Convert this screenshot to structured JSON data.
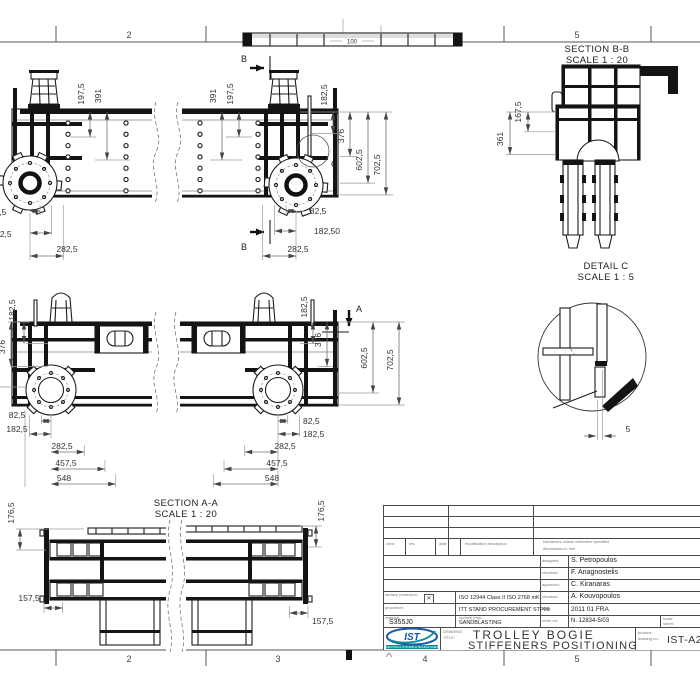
{
  "frame": {
    "zones_top": [
      "2",
      "5"
    ],
    "zones_bottom": [
      "2",
      "3",
      "4",
      "5"
    ]
  },
  "views": {
    "strip": {
      "dim": "100"
    },
    "cut_labels": {
      "a": "A",
      "b": "B"
    },
    "section_bb": {
      "title": "SECTION B-B",
      "scale": "SCALE 1 : 20"
    },
    "section_aa": {
      "title": "SECTION A-A",
      "scale": "SCALE 1 : 20"
    },
    "detail_c": {
      "title": "DETAIL C",
      "scale": "SCALE 1 : 5",
      "ref": "C"
    }
  },
  "dims": {
    "top": {
      "tl1": "197,5",
      "tl2": "391",
      "tr1": "391",
      "tr2": "197,5",
      "rv1": "182,5",
      "rv2": "376",
      "rv3": "602,5",
      "rv4": "702,5",
      "br1": "82,5",
      "br2": "182,50",
      "br3": "282,5",
      "bl1": "82,5",
      "bl2": "182,5",
      "bl3": "282,5"
    },
    "mid": {
      "lv1": "182,5",
      "lv2": "376",
      "rv1": "182,5",
      "rv2": "376",
      "rv3": "602,5",
      "rv4": "702,5",
      "bl1": "82,5",
      "bl2": "182,5",
      "bl3": "282,5",
      "bl4": "457,5",
      "bl5": "548",
      "br1": "82,5",
      "br2": "182,5",
      "br3": "282,5",
      "br4": "457,5",
      "br5": "548"
    },
    "aa": {
      "vl": "176,5",
      "vr": "176,5",
      "hl": "157,5",
      "hr": "157,5"
    },
    "bb": {
      "v1": "167,5",
      "v2": "361"
    },
    "dc": {
      "t": "5"
    }
  },
  "title_block": {
    "header": {
      "c1": "zone",
      "c2": "rev.",
      "c3": "date",
      "c4": "modification description",
      "c5a": "tolerances unless otherwise specified",
      "c5b": "dimensions in mm"
    },
    "approvals": [
      {
        "label": "designed:",
        "value": "S. Petropoulos"
      },
      {
        "label": "checked:",
        "value": "F. Anagnostelis"
      },
      {
        "label": "approved:",
        "value": "C. Kiranaras"
      },
      {
        "label": "released:",
        "value": "A. Kouvopoulos"
      },
      {
        "label": "date:",
        "value": "2011 01 FRA"
      },
      {
        "label": "order no:",
        "value": "N. 12834-5/03"
      }
    ],
    "specs": {
      "surface_label": "surface protection:",
      "spec1": "ISO 12944 Class II   ISO 2768 mK",
      "proc_label": "procedure:",
      "spec2": "ITT STAND PROCUREMENT STP09",
      "material_label": "material:",
      "material": "S355J0",
      "prep_label": "surface prep.:",
      "spec3": "SANDBLASTING"
    },
    "scale_label": "scale:",
    "sheet_label": "sheet:",
    "title_label1": "DRAWING",
    "title_label2": "TITLE:",
    "num_label1": "product:",
    "num_label2": "drawing no:",
    "title1": "TROLLEY BOGIE",
    "title2": "STIFFENERS POSITIONING",
    "drawing_no": "IST-A23",
    "logo": {
      "text": "IST",
      "tagline": "INDUSTRIAL SYSTEMS & TECHNOLOGIES"
    },
    "colors": {
      "logo_blue": "#1558a8",
      "logo_teal": "#0d8c96"
    }
  }
}
